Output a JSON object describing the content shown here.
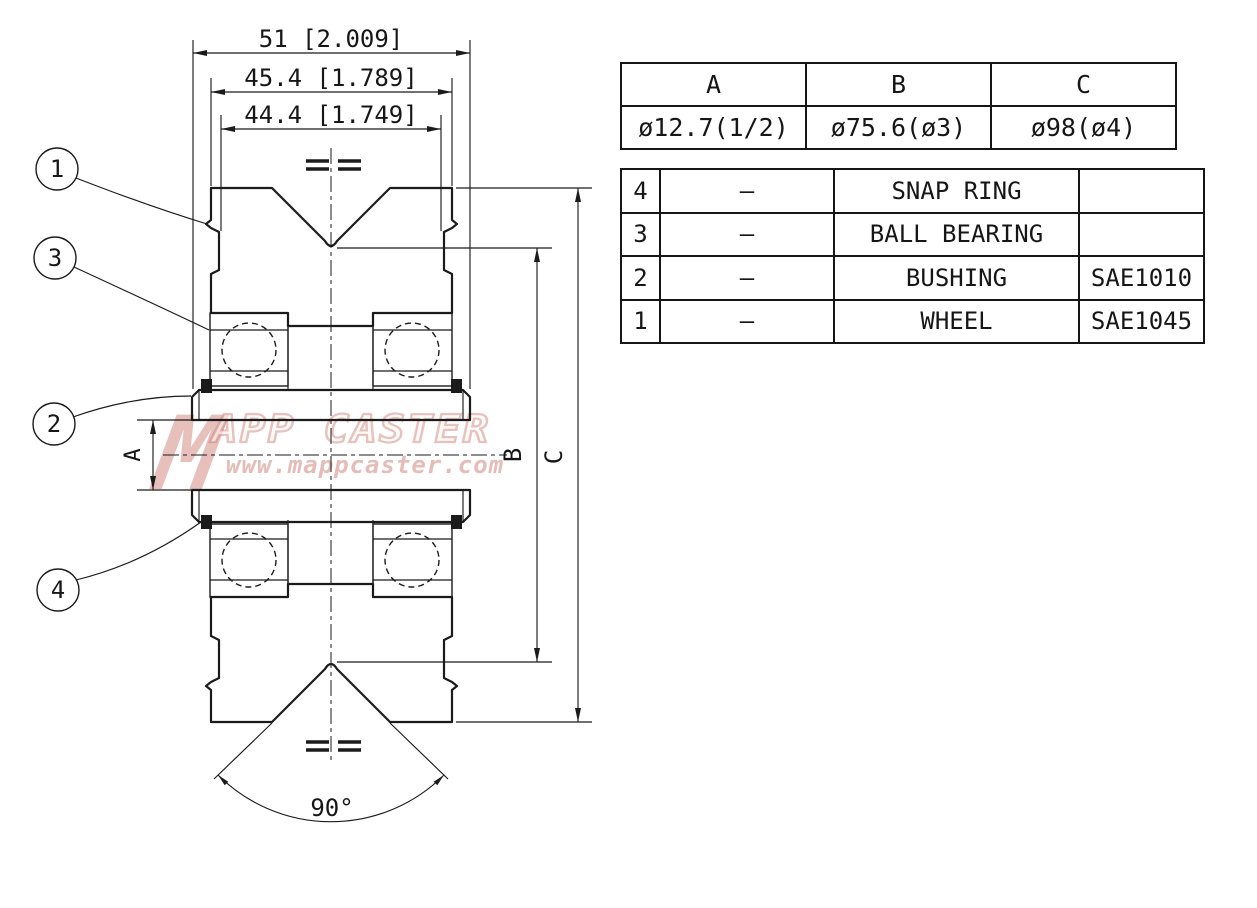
{
  "drawing": {
    "dimensions": {
      "overall_width": "51 [2.009]",
      "hub_width": "45.4 [1.789]",
      "bearing_width": "44.4 [1.749]",
      "bore_label": "A",
      "groove_dia_label": "B",
      "outer_dia_label": "C",
      "groove_angle": "90°"
    },
    "balloons": {
      "wheel": "1",
      "bushing": "2",
      "ball_bearing": "3",
      "snap_ring": "4"
    }
  },
  "size_table": {
    "headers": [
      "A",
      "B",
      "C"
    ],
    "values": [
      "ø12.7(1/2)",
      "ø75.6(ø3)",
      "ø98(ø4)"
    ]
  },
  "parts_table": {
    "rows": [
      {
        "no": "4",
        "qty": "–",
        "name": "SNAP RING",
        "material": ""
      },
      {
        "no": "3",
        "qty": "–",
        "name": "BALL BEARING",
        "material": ""
      },
      {
        "no": "2",
        "qty": "–",
        "name": "BUSHING",
        "material": "SAE1010"
      },
      {
        "no": "1",
        "qty": "–",
        "name": "WHEEL",
        "material": "SAE1045"
      }
    ]
  },
  "watermark": {
    "logo": "M",
    "brand": "APP CASTER",
    "url": "www.mappcaster.com"
  },
  "colors": {
    "line": "#1b1b1b",
    "watermark": "#c66a5f",
    "paper": "#ffffff"
  }
}
